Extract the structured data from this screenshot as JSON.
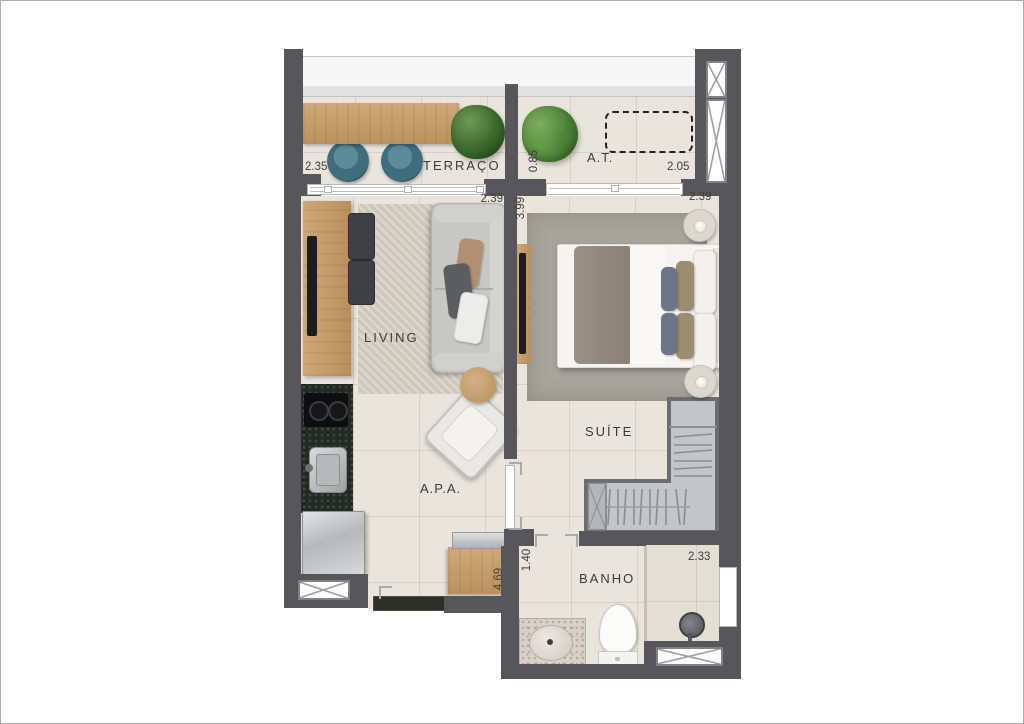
{
  "plan_type": "apartment-floor-plan",
  "rooms": {
    "terraco": {
      "label": "TERRAÇO",
      "dim_w": "2.35"
    },
    "at": {
      "label": "A.T.",
      "dim_w": "2.05",
      "dim_h": "0.85"
    },
    "living": {
      "label": "LIVING",
      "dim_w": "2.39"
    },
    "suite": {
      "label": "SUÍTE",
      "dim_w": "2.39",
      "dim_h": "3.99"
    },
    "apa": {
      "label": "A.P.A.",
      "dim_h": "4.69"
    },
    "banho": {
      "label": "BANHO",
      "dim_w": "2.33",
      "dim_h": "1.40"
    }
  },
  "colors": {
    "wall": "#57575b",
    "floor": "#eae5dc",
    "wood": "#c7a371",
    "stool_blue": "#3f6d7e",
    "kitchen_granite": "#242b24",
    "living_rug": "#d5d1c5",
    "suite_rug": "#a7a49b",
    "closet_fill": "#c3c6c9",
    "plant_green": "#528539",
    "sofa_gray": "#c7c7c3"
  }
}
